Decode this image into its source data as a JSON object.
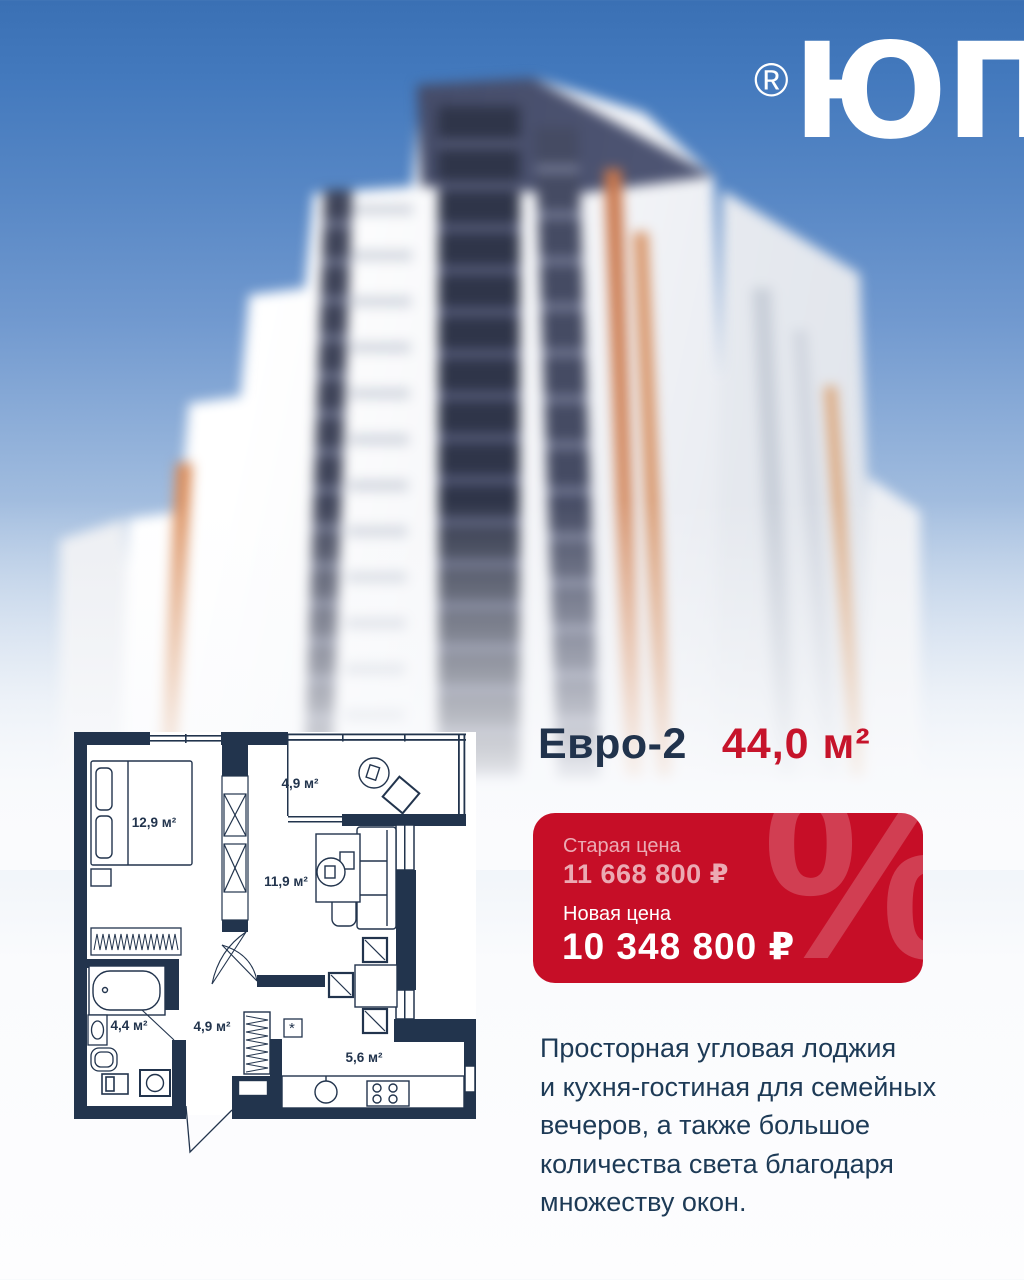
{
  "logo": {
    "trademark": "®",
    "text": "ЮП"
  },
  "listing": {
    "type_label": "Евро-2",
    "area": "44,0 м²"
  },
  "price_card": {
    "old_label": "Старая цена",
    "old_price": "11 668 800 ₽",
    "new_label": "Новая цена",
    "new_price": "10 348 800 ₽",
    "percent_watermark": "%"
  },
  "description": "Просторная угловая лоджия\nи кухня-гостиная для семейных\nвечеров, а также большое\nколичества света благодаря\nмножеству окон.",
  "floor_plan": {
    "bedroom": "12,9 м²",
    "loggia": "4,9 м²",
    "living_room": "11,9 м²",
    "bathroom": "4,4 м²",
    "hallway": "4,9 м²",
    "kitchen": "5,6 м²",
    "vent_marker": "*"
  },
  "colors": {
    "accent_red": "#c60e27",
    "navy": "#21334c",
    "sky_blue": "#3a70b4",
    "plan_wall": "#22344d"
  }
}
